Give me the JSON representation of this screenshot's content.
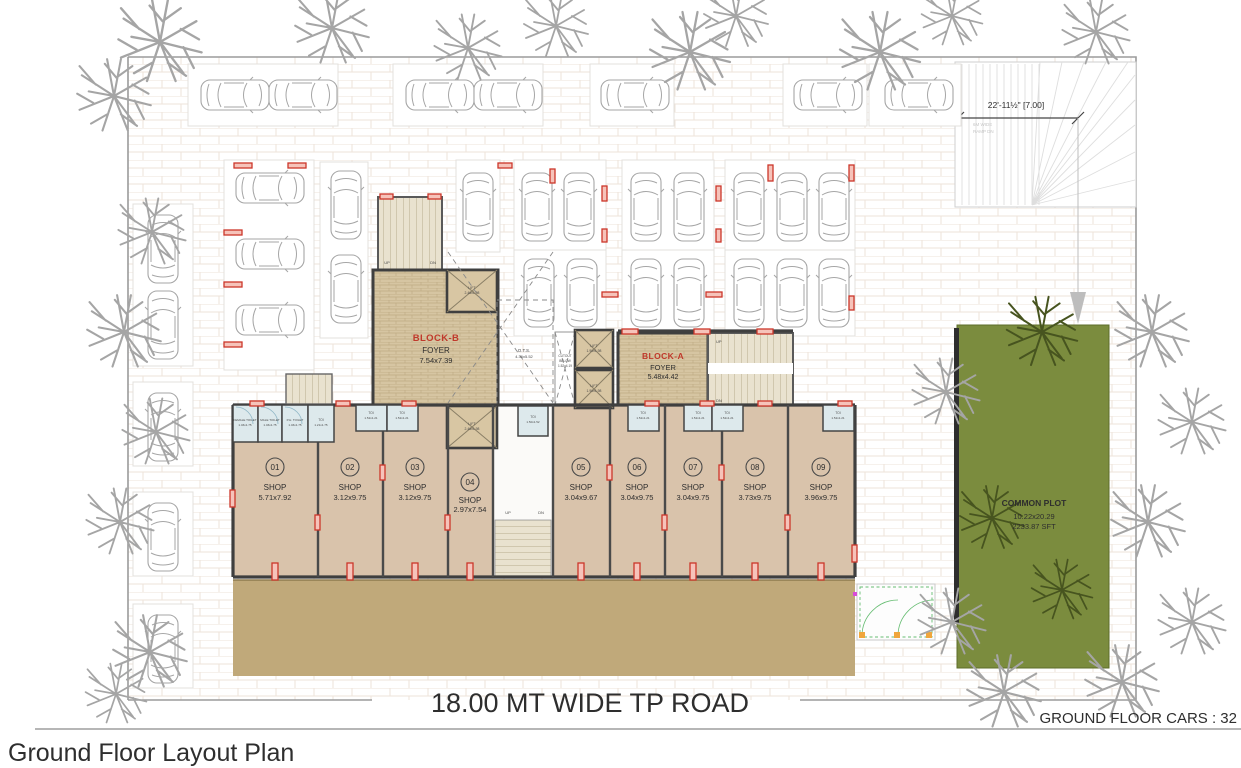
{
  "page": {
    "title": "Ground Floor Layout Plan",
    "footer_note": "GROUND FLOOR CARS : 32"
  },
  "plan": {
    "road_label": "18.00 MT WIDE TP ROAD",
    "ramp": {
      "dimension": "22'-11½\" [7.00]",
      "note_line1": "6M WIDE",
      "note_line2": "RAMP DN"
    },
    "common_plot": {
      "name": "COMMON PLOT",
      "dim": "10.22x20.29",
      "area": "2233.87 SFT"
    },
    "block_b": {
      "name": "BLOCK-B",
      "kind": "FOYER",
      "dim": "7.54x7.39"
    },
    "block_a": {
      "name": "BLOCK-A",
      "kind": "FOYER",
      "dim": "5.48x4.42"
    },
    "ots": {
      "name": "O.T.S.",
      "dim": "4.36x5.52"
    },
    "cutout": {
      "line1": "CUTOUT",
      "line2": "BELOW",
      "dim": "1.52x4.19"
    },
    "lift_large": {
      "name": "LIFT",
      "dim": "2.46x1.98"
    },
    "lift_small": {
      "name": "LIFT",
      "dim": "1.90x1.98"
    },
    "stair": {
      "up": "UP",
      "dn": "DN"
    },
    "toilets": {
      "female": {
        "name": "FEMALE TOILET",
        "dim": "1.46x1.75"
      },
      "male": {
        "name": "MALE TOILET",
        "dim": "1.46x1.75"
      },
      "ph": {
        "name": "P.H. TOILET",
        "dim": "1.46x1.75"
      },
      "toi_a": {
        "name": "TOI",
        "dim": "1.21x1.75"
      },
      "toi_b": {
        "name": "TOI",
        "dim": "1.52x1.21"
      },
      "toi_c": {
        "name": "TOI",
        "dim": "1.50x1.52"
      }
    },
    "shops": [
      {
        "number": "01",
        "label": "SHOP",
        "dim": "5.71x7.92"
      },
      {
        "number": "02",
        "label": "SHOP",
        "dim": "3.12x9.75"
      },
      {
        "number": "03",
        "label": "SHOP",
        "dim": "3.12x9.75"
      },
      {
        "number": "04",
        "label": "SHOP",
        "dim": "2.97x7.54"
      },
      {
        "number": "05",
        "label": "SHOP",
        "dim": "3.04x9.67"
      },
      {
        "number": "06",
        "label": "SHOP",
        "dim": "3.04x9.75"
      },
      {
        "number": "07",
        "label": "SHOP",
        "dim": "3.04x9.75"
      },
      {
        "number": "08",
        "label": "SHOP",
        "dim": "3.73x9.75"
      },
      {
        "number": "09",
        "label": "SHOP",
        "dim": "3.96x9.75"
      }
    ]
  },
  "icons": {
    "car": "car-icon",
    "tree": "tree-icon",
    "column_marker": "column-marker-icon"
  },
  "colors": {
    "wall": "#3f3f3f",
    "shop_floor": "#d9c3ab",
    "foyer_floor": "#d6c5a2",
    "road": "#c0a97a",
    "common_plot_green": "#7b8c3e",
    "column_red": "#cc362a",
    "toilet_floor": "#dde9ec",
    "stair_floor": "#e9e2cf",
    "block_label_red": "#c0392b"
  }
}
